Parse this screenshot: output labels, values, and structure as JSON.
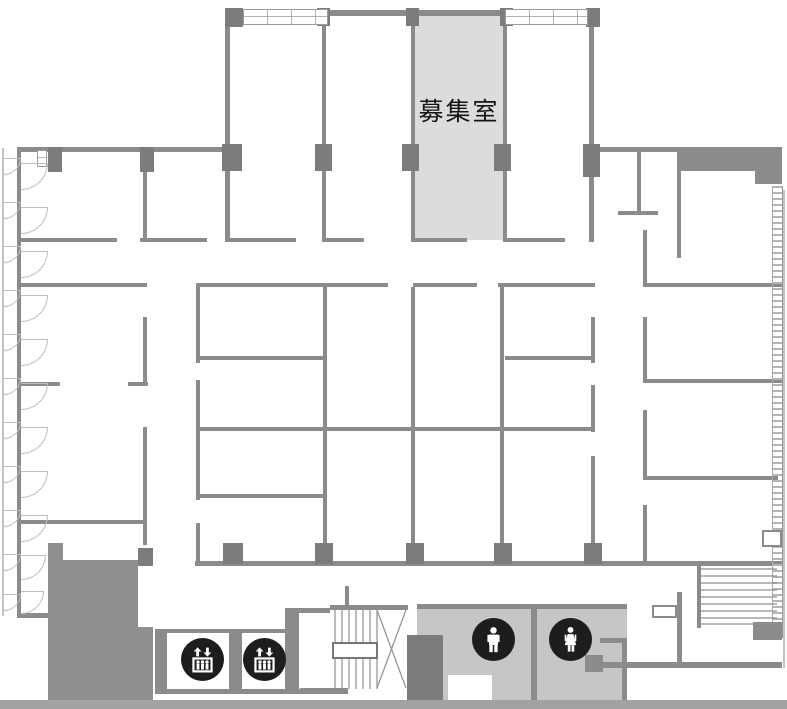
{
  "floorplan": {
    "vacant_room_label": "募集室",
    "colors": {
      "wall": "#8b8b8b",
      "pillar": "#7c7c7c",
      "highlight": "#dcdcdc",
      "service_zone": "#c6c6c6",
      "core": "#8f8f8f",
      "baseline": "#a2a2a2",
      "icon_bg": "#1d1d1d",
      "icon_fg": "#ffffff"
    },
    "icons": {
      "elevator_left": "elevator-icon",
      "elevator_right": "elevator-icon",
      "mens_restroom": "male-restroom-icon",
      "womens_restroom": "female-restroom-icon"
    }
  }
}
